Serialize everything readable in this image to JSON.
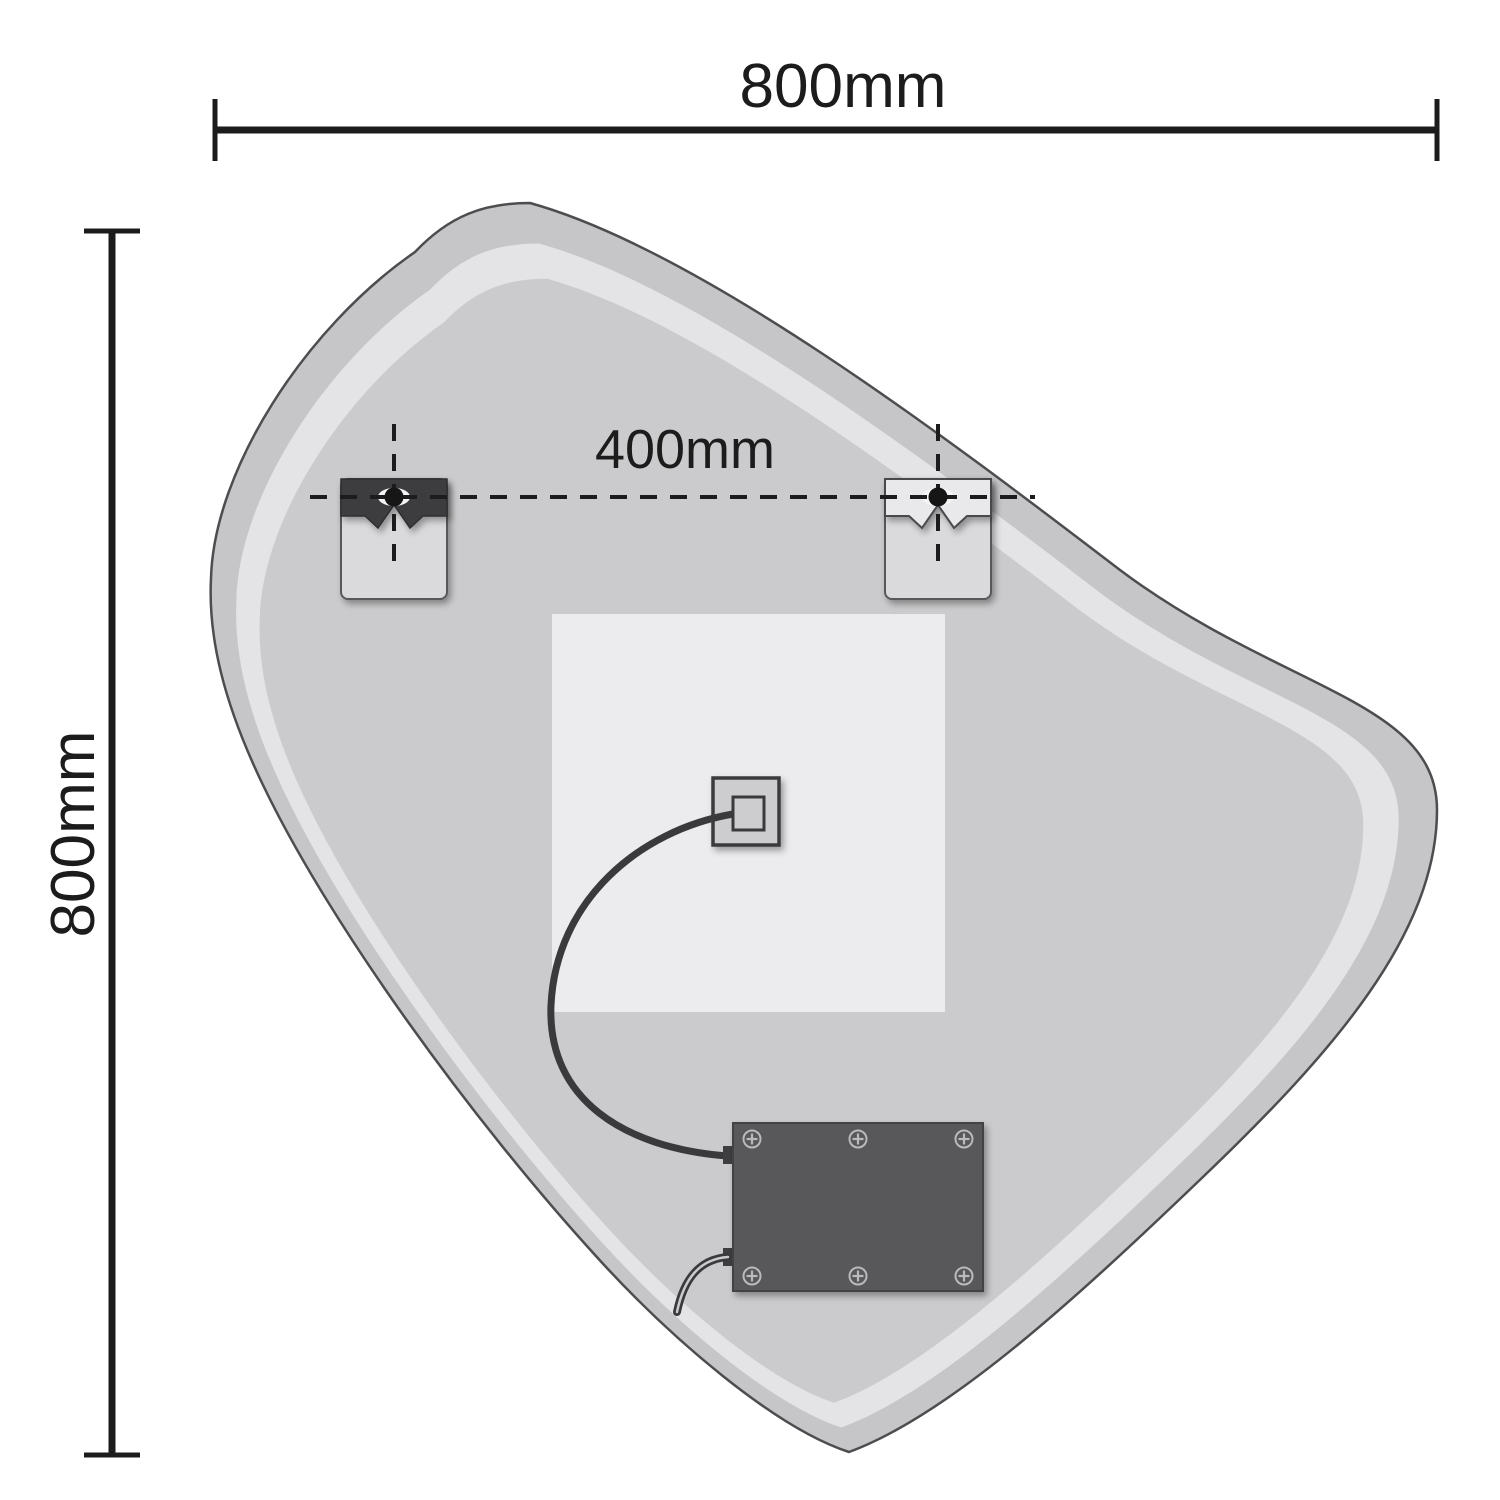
{
  "diagram": {
    "dim_width": {
      "label": "800mm"
    },
    "dim_height": {
      "label": "800mm"
    },
    "dim_spacing": {
      "label": "400mm"
    },
    "colors": {
      "background": "#ffffff",
      "line": "#1c1c1c",
      "mirror_edge": "#c6c6c8",
      "frost_band": "#e4e4e6",
      "mirror_back": "#cbcbcd",
      "backing_panel": "#ececee",
      "bracket_body": "#dadadc",
      "bracket_plate_dark": "#3e3e40",
      "bracket_plate_light": "#e9e9eb",
      "keyhole_slot": "#f4f4f6",
      "screw_head": "#161616",
      "junction_box": "#cdcdcf",
      "driver_box": "#58585a",
      "cable": "#3a3a3c"
    }
  }
}
